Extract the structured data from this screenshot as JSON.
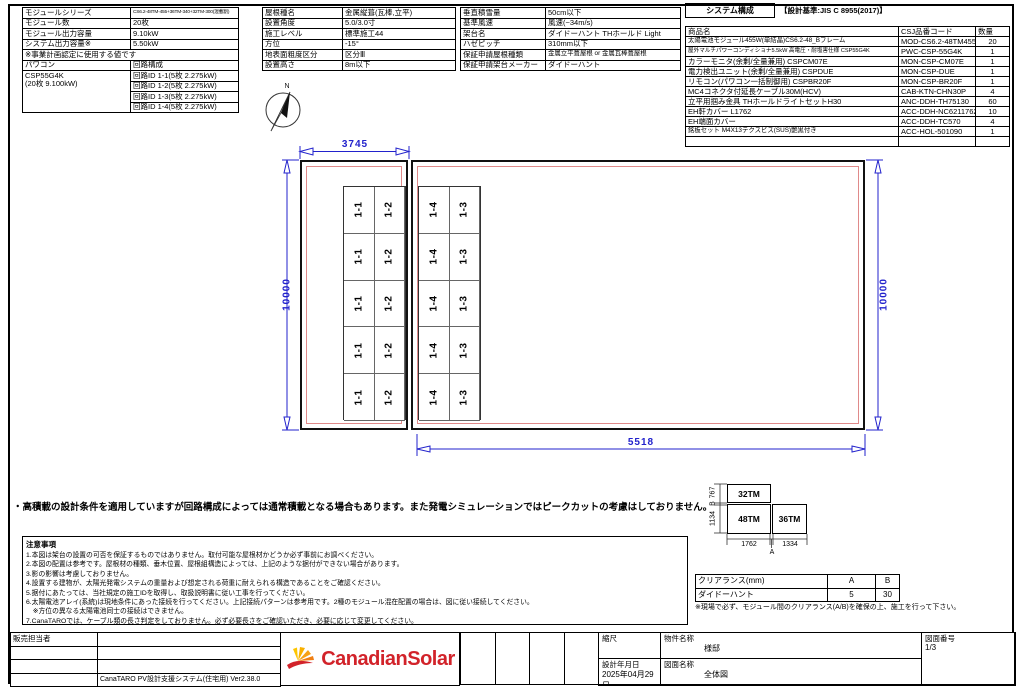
{
  "colors": {
    "dim_blue": "#2222cc",
    "offset_red": "#e08a8a",
    "logo_red": "#d2232a",
    "logo_orange": "#f07f13",
    "logo_yellow": "#f9b000"
  },
  "module_info": {
    "rows": [
      {
        "label": "モジュールシリーズ",
        "value": "CS6.2-48TM-455+36TM-340+32TM-300(混載割)",
        "small": true
      },
      {
        "label": "モジュール数",
        "value": "20枚"
      },
      {
        "label": "モジュール出力容量",
        "value": "9.10kW"
      },
      {
        "label": "システム出力容量※",
        "value": "5.50kW"
      }
    ],
    "note": "※事業計画認定に使用する値です",
    "pcs_label": "パワコン",
    "circuit_label": "回路構成",
    "pcs_name": "CSP55G4K",
    "pcs_sub": "(20枚 9.100kW)",
    "circuits": [
      "回路ID 1-1(5枚 2.275kW)",
      "回路ID 1-2(5枚 2.275kW)",
      "回路ID 1-3(5枚 2.275kW)",
      "回路ID 1-4(5枚 2.275kW)"
    ]
  },
  "roof_info": {
    "rows": [
      {
        "label": "屋根種名",
        "value": "金属縦葺(瓦棒,立平)"
      },
      {
        "label": "設置角度",
        "value": "5.0/3.0寸"
      },
      {
        "label": "施工レベル",
        "value": "標準施工44"
      },
      {
        "label": "方位",
        "value": "-15°"
      },
      {
        "label": "地表面粗度区分",
        "value": "区分Ⅲ"
      },
      {
        "label": "設置高さ",
        "value": "8m以下"
      }
    ]
  },
  "install_info": {
    "rows": [
      {
        "label": "垂直積雪量",
        "value": "50cm以下"
      },
      {
        "label": "基準風速",
        "value": "風速(~34m/s)"
      },
      {
        "label": "架台名",
        "value": "ダイドーハント THホールド Light"
      },
      {
        "label": "ハゼピッチ",
        "value": "310mm以下"
      },
      {
        "label": "保証申請屋根種類",
        "value": "金属立平葺屋根 or 金属瓦棒葺屋根",
        "small": true
      },
      {
        "label": "保証申請架台メーカー",
        "value": "ダイドーハント"
      }
    ]
  },
  "system_config": {
    "title": "システム構成",
    "standard": "【設計基準:JIS C 8955(2017)】",
    "headers": [
      "商品名",
      "CSJ品番コード",
      "数量"
    ],
    "rows": [
      {
        "name": "太陽電池モジュール455W(単結晶)CS6.2-48_Bフレーム",
        "code": "MOD-CS6.2-48TM455B",
        "qty": "20"
      },
      {
        "name": "屋外マルチパワーコンディショナ5.5kW 高電圧・耐塩害仕様 CSP55G4K",
        "code": "PWC-CSP-55G4K",
        "qty": "1"
      },
      {
        "name": "カラーモニタ(余剰/全量兼用) CSPCM07E",
        "code": "MON-CSP-CM07E",
        "qty": "1"
      },
      {
        "name": "電力検出ユニット(余剰/全量兼用) CSPDUE",
        "code": "MON-CSP-DUE",
        "qty": "1"
      },
      {
        "name": "リモコン(パワコン一括制御用) CSPBR20F",
        "code": "MON-CSP-BR20F",
        "qty": "1"
      },
      {
        "name": "MC4コネクタ付延長ケーブル30M(HCV)",
        "code": "CAB-KTN-CHN30P",
        "qty": "4"
      },
      {
        "name": "立平用掴み金具 THホールドライトセットH30",
        "code": "ANC-DDH-TH75130",
        "qty": "60"
      },
      {
        "name": "EH軒カバー L1762",
        "code": "ACC-DDH-NC6211762",
        "qty": "10"
      },
      {
        "name": "EH端面カバー",
        "code": "ACC-DDH-TC570",
        "qty": "4"
      },
      {
        "name": "銘板セット M4X13テクスビス(SUS)艶黒付き",
        "code": "ACC-HOL-501090",
        "qty": "1"
      },
      {
        "name": "",
        "code": "",
        "qty": ""
      }
    ]
  },
  "drawing": {
    "compass_n": "N",
    "dim_top": "3745",
    "dim_bottom": "5518",
    "dim_left": "10000",
    "dim_right": "10000",
    "left_array_cols": [
      "1-1",
      "1-2"
    ],
    "right_array_cols": [
      "1-4",
      "1-3"
    ],
    "array_rows": 5
  },
  "highload_note": "・高積載の設計条件を適用していますが回路構成によっては通常積載となる場合もあります。また発電シミュレーションではピークカットの考慮はしておりません。",
  "notes": {
    "title": "注意事項",
    "lines": [
      "1.本図は架台の設置の可否を保証するものではありません。取付可能な屋根材かどうか必ず事前にお調べください。",
      "2.本図の配置は参考です。屋根材の種類、垂木位置、屋根組構造によっては、上記のような据付ができない場合があります。",
      "3.影の影響は考慮しておりません。",
      "4.設置する建物が、太陽光発電システムの重量および想定される荷重に耐えられる構造であることをご確認ください。",
      "5.据付にあたっては、当社規定の施工IDを取得し、取扱説明書に従い工事を行ってください。",
      "6.太陽電池アレイ(系統)は現地条件にあった接続を行ってください。上記接続パターンは参考用です。2種のモジュール混在配置の場合は、図に従い接続してください。",
      "　※方位の異なる太陽電池同士の接続はできません。",
      "7.CanaTAROでは、ケーブル類の長さ判定をしておりません。必ず必要長さをご確認いただき、必要に応じて変更してください。"
    ]
  },
  "clearance": {
    "box_top": "32TM",
    "box_left": "48TM",
    "box_right": "36TM",
    "dim_top_h": "767",
    "dim_bottom_h": "1134",
    "dim_left_w": "1762",
    "dim_right_w": "1334",
    "gap_a": "A",
    "gap_b": "B",
    "table": {
      "header_label": "クリアランス(mm)",
      "header_a": "A",
      "header_b": "B",
      "row_label": "ダイドーハント",
      "row_a": "5",
      "row_b": "30"
    },
    "note": "※現場で必ず、モジュール間のクリアランス(A/B)を確保の上、施工を行って下さい。"
  },
  "footer": {
    "sales_label": "販売担当者",
    "software": "CanaTARO PV設計支援システム(住宅用) Ver2.38.0",
    "logo_text": "CanadianSolar",
    "title_block": {
      "scale_label": "縮尺",
      "property_label": "物件名称",
      "property_value": "様邸",
      "date_label": "設計年月日",
      "date_value": "2025年04月29日",
      "drawing_label": "図面名称",
      "drawing_value": "全体図",
      "number_label": "図面番号",
      "number_value": "1/3"
    }
  }
}
